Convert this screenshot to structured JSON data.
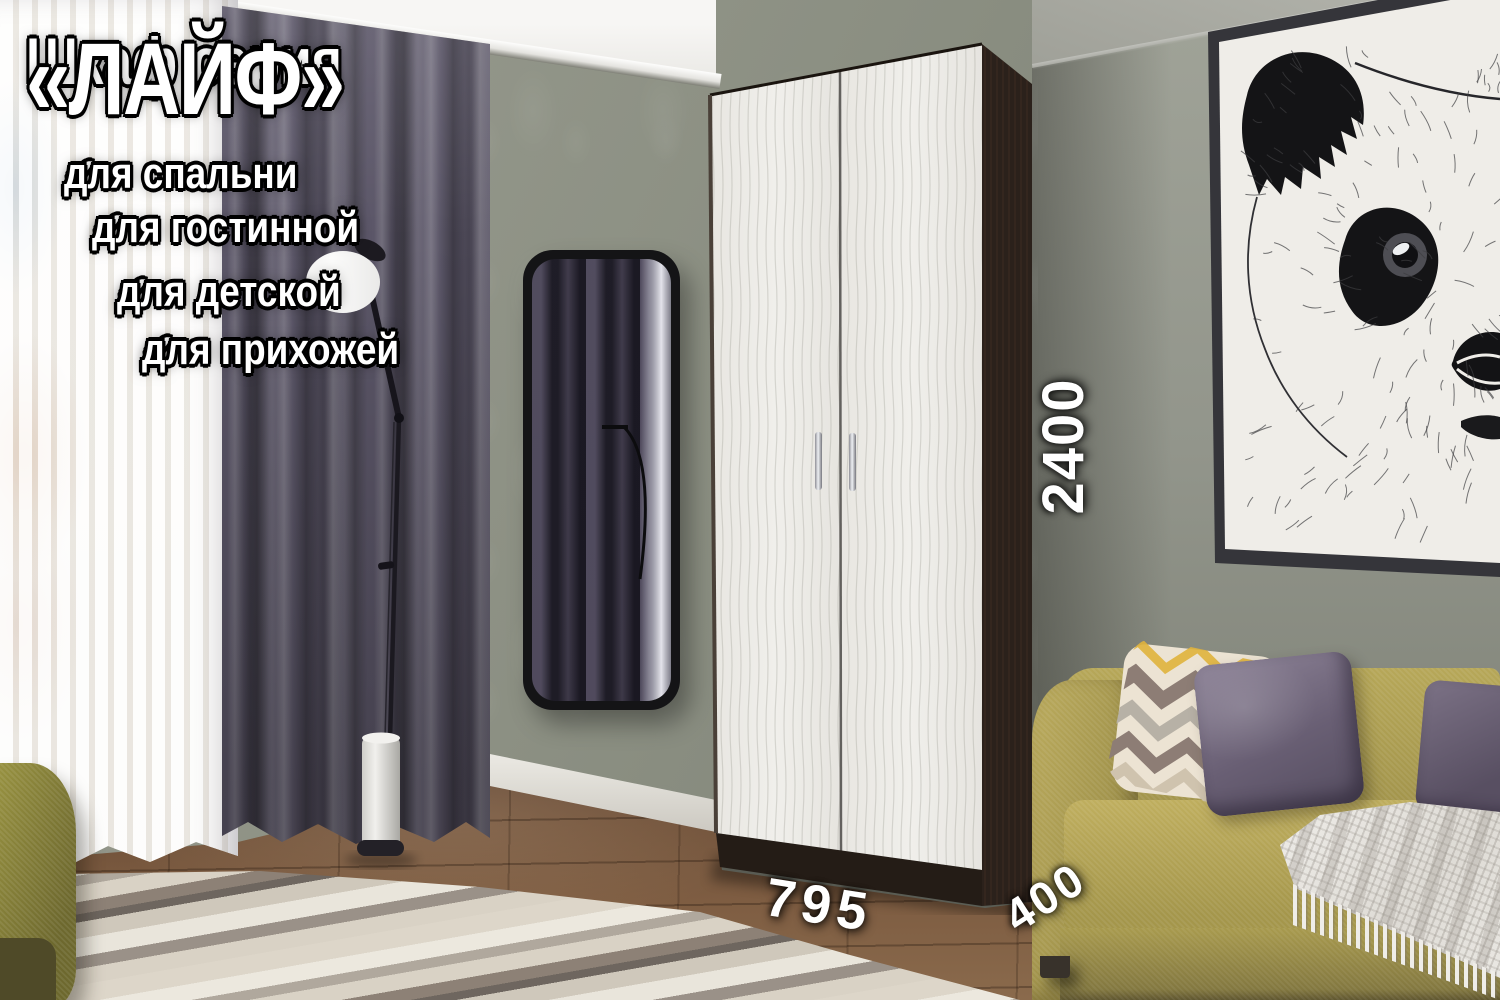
{
  "overlay": {
    "title": {
      "prefix": "Шкаф серия",
      "name": "«ЛАЙФ»"
    },
    "check_icon": "✔",
    "features": [
      "для спальни",
      "для гостинной",
      "для детской",
      "для прихожей"
    ],
    "dimensions": {
      "height_mm": "2400",
      "width_mm": "795",
      "depth_mm": "400"
    }
  },
  "palette": {
    "wall_green_gray": "#8b8e82",
    "ceiling_white": "#f3f2ef",
    "curtain_dark_violet": "#5a5565",
    "sheer_white": "#f7f5f1",
    "wardrobe_body_wenge": "#2b211b",
    "wardrobe_door_white": "#edebe6",
    "handle_chrome": "#c9c9cf",
    "mirror_frame_black": "#141416",
    "sofa_mustard": "#ab9d50",
    "pillow_purple": "#6b6175",
    "pillow_zigzag_cream": "#ece3d3",
    "zigzag_accent_yellow": "#e0b23c",
    "throw_white": "#e7e5e0",
    "rug_beige": "#d6cfc2",
    "floor_brown": "#6f5038",
    "picture_frame_black": "#35353a",
    "text_white": "#ffffff",
    "text_outline_black": "#000000"
  }
}
